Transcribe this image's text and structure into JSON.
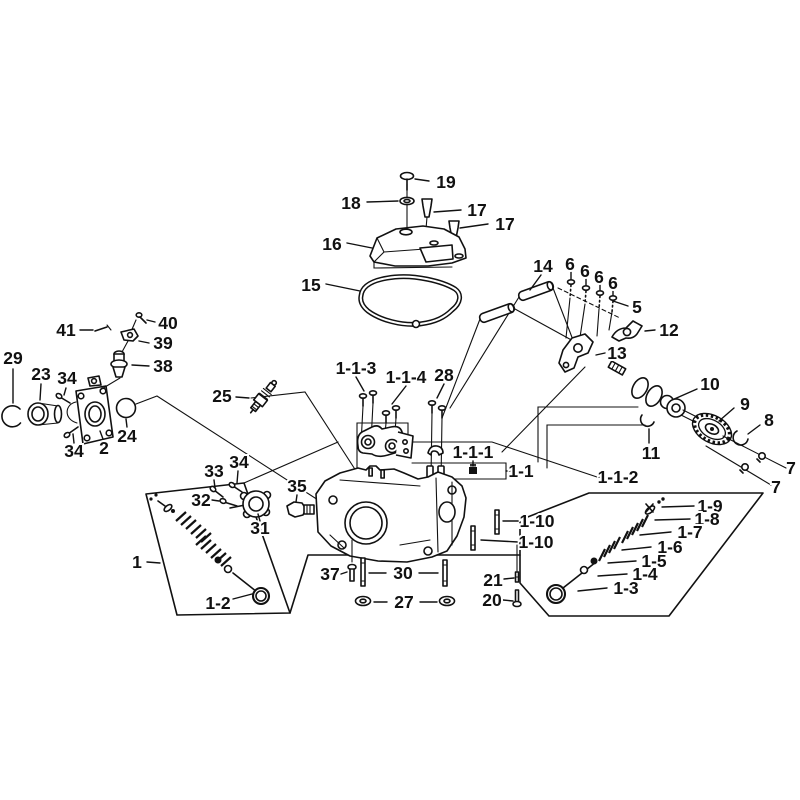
{
  "figure": {
    "type": "exploded-parts-diagram",
    "subject": "engine-cylinder-head-assembly",
    "background_color": "#ffffff",
    "ink_color": "#111111"
  },
  "callouts": [
    {
      "label": "19",
      "part": "cover-screw",
      "x": 446,
      "y": 182,
      "leaders": [
        [
          [
            429,
            181
          ],
          [
            415,
            179
          ]
        ]
      ]
    },
    {
      "label": "18",
      "part": "washer",
      "x": 351,
      "y": 203,
      "leaders": [
        [
          [
            367,
            202
          ],
          [
            398,
            201
          ]
        ]
      ]
    },
    {
      "label": "17",
      "part": "breather-cap",
      "x": 477,
      "y": 210,
      "leaders": [
        [
          [
            461,
            210
          ],
          [
            434,
            212
          ]
        ]
      ]
    },
    {
      "label": "17",
      "part": "breather-cap",
      "x": 505,
      "y": 224,
      "leaders": [
        [
          [
            488,
            224
          ],
          [
            460,
            228
          ]
        ]
      ]
    },
    {
      "label": "16",
      "part": "cylinder-head-cover",
      "x": 332,
      "y": 244,
      "leaders": [
        [
          [
            347,
            243
          ],
          [
            372,
            248
          ]
        ]
      ]
    },
    {
      "label": "15",
      "part": "head-cover-gasket",
      "x": 311,
      "y": 285,
      "leaders": [
        [
          [
            326,
            284
          ],
          [
            360,
            291
          ]
        ]
      ]
    },
    {
      "label": "14",
      "part": "rocker-shaft-pin",
      "x": 543,
      "y": 266,
      "leaders": [
        [
          [
            541,
            275
          ],
          [
            530,
            290
          ]
        ]
      ]
    },
    {
      "label": "6",
      "part": "pivot-bolt",
      "x": 570,
      "y": 264,
      "leaders": [
        [
          [
            571,
            272
          ],
          [
            571,
            279
          ]
        ]
      ]
    },
    {
      "label": "6",
      "part": "pivot-bolt",
      "x": 585,
      "y": 271,
      "leaders": [
        [
          [
            586,
            278
          ],
          [
            586,
            285
          ]
        ]
      ]
    },
    {
      "label": "6",
      "part": "pivot-bolt",
      "x": 599,
      "y": 277,
      "leaders": [
        [
          [
            600,
            284
          ],
          [
            600,
            290
          ]
        ]
      ]
    },
    {
      "label": "6",
      "part": "pivot-bolt",
      "x": 613,
      "y": 283,
      "leaders": [
        [
          [
            613,
            290
          ],
          [
            613,
            295
          ]
        ]
      ]
    },
    {
      "label": "5",
      "part": "rocker-pivot",
      "x": 637,
      "y": 307,
      "leaders": [
        [
          [
            628,
            306
          ],
          [
            613,
            301
          ]
        ]
      ]
    },
    {
      "label": "12",
      "part": "rocker-arm",
      "x": 669,
      "y": 330,
      "leaders": [
        [
          [
            655,
            330
          ],
          [
            645,
            331
          ]
        ]
      ]
    },
    {
      "label": "13",
      "part": "rocker-arm",
      "x": 617,
      "y": 353,
      "leaders": [
        [
          [
            605,
            353
          ],
          [
            596,
            355
          ]
        ]
      ]
    },
    {
      "label": "10",
      "part": "camshaft",
      "x": 710,
      "y": 384,
      "leaders": [
        [
          [
            697,
            389
          ],
          [
            672,
            400
          ]
        ]
      ]
    },
    {
      "label": "9",
      "part": "cam-gear",
      "x": 745,
      "y": 404,
      "leaders": [
        [
          [
            734,
            408
          ],
          [
            719,
            421
          ]
        ]
      ]
    },
    {
      "label": "8",
      "part": "retaining-clip",
      "x": 769,
      "y": 420,
      "leaders": [
        [
          [
            760,
            425
          ],
          [
            748,
            434
          ]
        ]
      ]
    },
    {
      "label": "7",
      "part": "bolt",
      "x": 791,
      "y": 468,
      "leaders": []
    },
    {
      "label": "7",
      "part": "bolt",
      "x": 776,
      "y": 487,
      "leaders": []
    },
    {
      "label": "11",
      "part": "clip",
      "x": 651,
      "y": 453,
      "leaders": [
        [
          [
            649,
            443
          ],
          [
            649,
            429
          ]
        ]
      ]
    },
    {
      "label": "41",
      "part": "bolt-clip",
      "x": 66,
      "y": 330,
      "leaders": [
        [
          [
            80,
            330
          ],
          [
            93,
            330
          ]
        ]
      ]
    },
    {
      "label": "40",
      "part": "screw",
      "x": 168,
      "y": 323,
      "leaders": [
        [
          [
            155,
            322
          ],
          [
            147,
            320
          ]
        ]
      ]
    },
    {
      "label": "39",
      "part": "bracket",
      "x": 163,
      "y": 343,
      "leaders": [
        [
          [
            149,
            343
          ],
          [
            139,
            341
          ]
        ]
      ]
    },
    {
      "label": "38",
      "part": "breather-valve",
      "x": 163,
      "y": 366,
      "leaders": [
        [
          [
            149,
            366
          ],
          [
            132,
            365
          ]
        ]
      ]
    },
    {
      "label": "29",
      "part": "snap-ring",
      "x": 13,
      "y": 358,
      "leaders": [
        [
          [
            13,
            369
          ],
          [
            13,
            403
          ]
        ]
      ]
    },
    {
      "label": "23",
      "part": "guide-sleeve",
      "x": 41,
      "y": 374,
      "leaders": [
        [
          [
            41,
            384
          ],
          [
            40,
            400
          ]
        ]
      ]
    },
    {
      "label": "34",
      "part": "screw",
      "x": 67,
      "y": 378,
      "leaders": [
        [
          [
            66,
            388
          ],
          [
            64,
            395
          ]
        ]
      ]
    },
    {
      "label": "24",
      "part": "o-ring",
      "x": 127,
      "y": 436,
      "leaders": [
        [
          [
            127,
            427
          ],
          [
            126,
            419
          ]
        ]
      ]
    },
    {
      "label": "2",
      "part": "intake-pipe",
      "x": 104,
      "y": 448,
      "leaders": [
        [
          [
            103,
            439
          ],
          [
            100,
            431
          ]
        ]
      ]
    },
    {
      "label": "34",
      "part": "screw",
      "x": 74,
      "y": 451,
      "leaders": [
        [
          [
            74,
            443
          ],
          [
            73,
            434
          ]
        ]
      ]
    },
    {
      "label": "25",
      "part": "spark-plug",
      "x": 222,
      "y": 396,
      "leaders": [
        [
          [
            236,
            397
          ],
          [
            249,
            398
          ]
        ]
      ]
    },
    {
      "label": "1-1-3",
      "part": "bolt",
      "x": 356,
      "y": 368,
      "leaders": [
        [
          [
            356,
            377
          ],
          [
            364,
            391
          ]
        ]
      ]
    },
    {
      "label": "1-1-4",
      "part": "bolt",
      "x": 406,
      "y": 377,
      "leaders": [
        [
          [
            406,
            386
          ],
          [
            392,
            404
          ]
        ]
      ]
    },
    {
      "label": "28",
      "part": "bolt",
      "x": 444,
      "y": 375,
      "leaders": [
        [
          [
            444,
            384
          ],
          [
            437,
            398
          ]
        ]
      ]
    },
    {
      "label": "1-1-1",
      "part": "nut",
      "x": 473,
      "y": 452,
      "leaders": [
        [
          [
            473,
            461
          ],
          [
            473,
            466
          ]
        ]
      ]
    },
    {
      "label": "1-1",
      "part": "insulator-set",
      "x": 521,
      "y": 471,
      "leaders": [
        [
          [
            510,
            471
          ],
          [
            506,
            471
          ]
        ]
      ]
    },
    {
      "label": "1-1-2",
      "part": "bracket-assembly",
      "x": 618,
      "y": 477,
      "leaders": [
        [
          [
            600,
            477
          ],
          [
            597,
            477
          ]
        ]
      ]
    },
    {
      "label": "1-10",
      "part": "stud",
      "x": 537,
      "y": 521,
      "leaders": [
        [
          [
            520,
            521
          ],
          [
            503,
            521
          ]
        ]
      ]
    },
    {
      "label": "1-10",
      "part": "stud",
      "x": 536,
      "y": 542,
      "leaders": [
        [
          [
            518,
            542
          ],
          [
            481,
            540
          ]
        ]
      ]
    },
    {
      "label": "33",
      "part": "screw",
      "x": 214,
      "y": 471,
      "leaders": [
        [
          [
            214,
            480
          ],
          [
            215,
            488
          ]
        ]
      ]
    },
    {
      "label": "34",
      "part": "screw",
      "x": 239,
      "y": 462,
      "leaders": [
        [
          [
            238,
            471
          ],
          [
            237,
            483
          ]
        ]
      ]
    },
    {
      "label": "32",
      "part": "bolt",
      "x": 201,
      "y": 500,
      "leaders": [
        [
          [
            212,
            500
          ],
          [
            219,
            501
          ]
        ]
      ]
    },
    {
      "label": "35",
      "part": "thermostat-sensor",
      "x": 297,
      "y": 486,
      "leaders": [
        [
          [
            297,
            495
          ],
          [
            296,
            502
          ]
        ]
      ]
    },
    {
      "label": "31",
      "part": "flange",
      "x": 260,
      "y": 528,
      "leaders": [
        [
          [
            260,
            521
          ],
          [
            258,
            514
          ]
        ]
      ]
    },
    {
      "label": "1",
      "part": "valve-assembly",
      "x": 137,
      "y": 562,
      "leaders": [
        [
          [
            147,
            562
          ],
          [
            160,
            563
          ]
        ]
      ]
    },
    {
      "label": "1-2",
      "part": "intake-valve",
      "x": 218,
      "y": 603,
      "leaders": [
        [
          [
            233,
            599
          ],
          [
            252,
            594
          ]
        ]
      ]
    },
    {
      "label": "37",
      "part": "bolt",
      "x": 330,
      "y": 574,
      "leaders": [
        [
          [
            341,
            574
          ],
          [
            347,
            572
          ]
        ]
      ]
    },
    {
      "label": "30",
      "part": "stud",
      "x": 403,
      "y": 573,
      "leaders": [
        [
          [
            386,
            573
          ],
          [
            369,
            573
          ]
        ],
        [
          [
            419,
            573
          ],
          [
            438,
            573
          ]
        ]
      ]
    },
    {
      "label": "27",
      "part": "sealing-washer",
      "x": 404,
      "y": 602,
      "leaders": [
        [
          [
            387,
            602
          ],
          [
            374,
            602
          ]
        ],
        [
          [
            420,
            602
          ],
          [
            437,
            602
          ]
        ]
      ]
    },
    {
      "label": "21",
      "part": "pin",
      "x": 493,
      "y": 580,
      "leaders": [
        [
          [
            504,
            579
          ],
          [
            514,
            578
          ]
        ]
      ]
    },
    {
      "label": "20",
      "part": "bolt",
      "x": 492,
      "y": 600,
      "leaders": [
        [
          [
            503,
            600
          ],
          [
            513,
            601
          ]
        ]
      ]
    },
    {
      "label": "1-9",
      "part": "valve-keepers",
      "x": 710,
      "y": 506,
      "leaders": [
        [
          [
            694,
            506
          ],
          [
            662,
            507
          ]
        ]
      ]
    },
    {
      "label": "1-8",
      "part": "spring-retainer",
      "x": 707,
      "y": 519,
      "leaders": [
        [
          [
            690,
            519
          ],
          [
            655,
            520
          ]
        ]
      ]
    },
    {
      "label": "1-7",
      "part": "outer-valve-spring",
      "x": 690,
      "y": 532,
      "leaders": [
        [
          [
            671,
            532
          ],
          [
            640,
            535
          ]
        ]
      ]
    },
    {
      "label": "1-6",
      "part": "inner-valve-spring",
      "x": 670,
      "y": 547,
      "leaders": [
        [
          [
            651,
            547
          ],
          [
            622,
            550
          ]
        ]
      ]
    },
    {
      "label": "1-5",
      "part": "valve-seal",
      "x": 654,
      "y": 561,
      "leaders": [
        [
          [
            636,
            561
          ],
          [
            608,
            563
          ]
        ]
      ]
    },
    {
      "label": "1-4",
      "part": "spring-seat",
      "x": 645,
      "y": 574,
      "leaders": [
        [
          [
            627,
            574
          ],
          [
            598,
            576
          ]
        ]
      ]
    },
    {
      "label": "1-3",
      "part": "exhaust-valve",
      "x": 626,
      "y": 588,
      "leaders": [
        [
          [
            607,
            588
          ],
          [
            578,
            591
          ]
        ]
      ]
    }
  ]
}
